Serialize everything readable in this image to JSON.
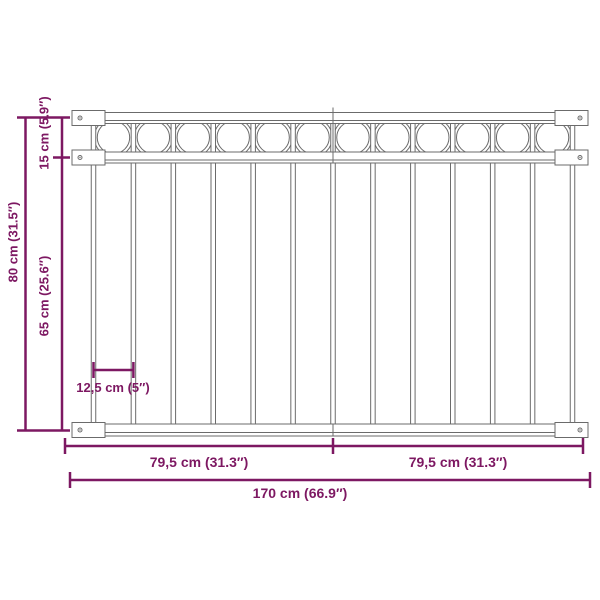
{
  "diagram": {
    "title": "fence-panel-dimension-diagram",
    "labels": {
      "height_total": "80 cm (31.5″)",
      "height_top": "15 cm (5.9″)",
      "height_lower": "65 cm (25.6″)",
      "bar_gap": "12,5 cm (5″)",
      "width_left": "79,5 cm (31.3″)",
      "width_right": "79,5 cm (31.3″)",
      "width_total": "170 cm (66.9″)"
    },
    "colors": {
      "dimension": "#7d1862",
      "outline": "#6b6b6b",
      "background": "#ffffff"
    },
    "structure": {
      "circle_count": 12,
      "bar_count": 13,
      "rail_count": 3,
      "bracket_count": 6
    }
  }
}
